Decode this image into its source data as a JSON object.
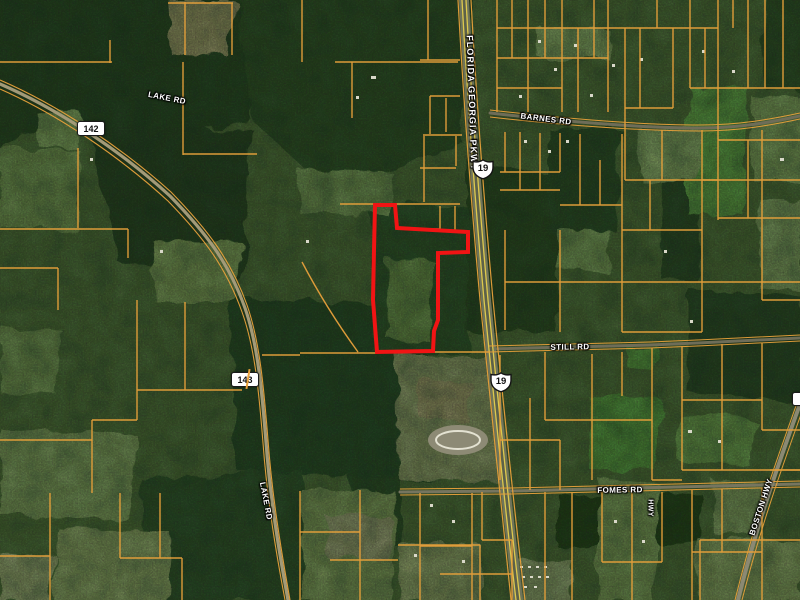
{
  "map": {
    "description": "Aerial satellite parcel map with red-outlined subject property along US 19",
    "road_labels": {
      "lake_rd_upper": "LAKE RD",
      "lake_rd_lower": "LAKE RD",
      "florida_georgia_pkwy": "FLORIDA GEORGIA PKWY",
      "barnes_rd": "BARNES RD",
      "still_rd": "STILL RD",
      "fomes_rd": "FOMES RD",
      "hwy_partial": "HWY",
      "boston_hwy": "BOSTON HWY"
    },
    "route_shields": {
      "state_route_142": "142",
      "state_route_143": "143",
      "us_route_19_north": "19",
      "us_route_19_south": "19"
    },
    "subject_parcel": {
      "outline_color": "#f11414"
    },
    "colors": {
      "parcel_lines": "#e8a13b",
      "highway_stripes": "#dcc84f",
      "forest": "#2e4829",
      "fields": "#8aa565"
    }
  }
}
